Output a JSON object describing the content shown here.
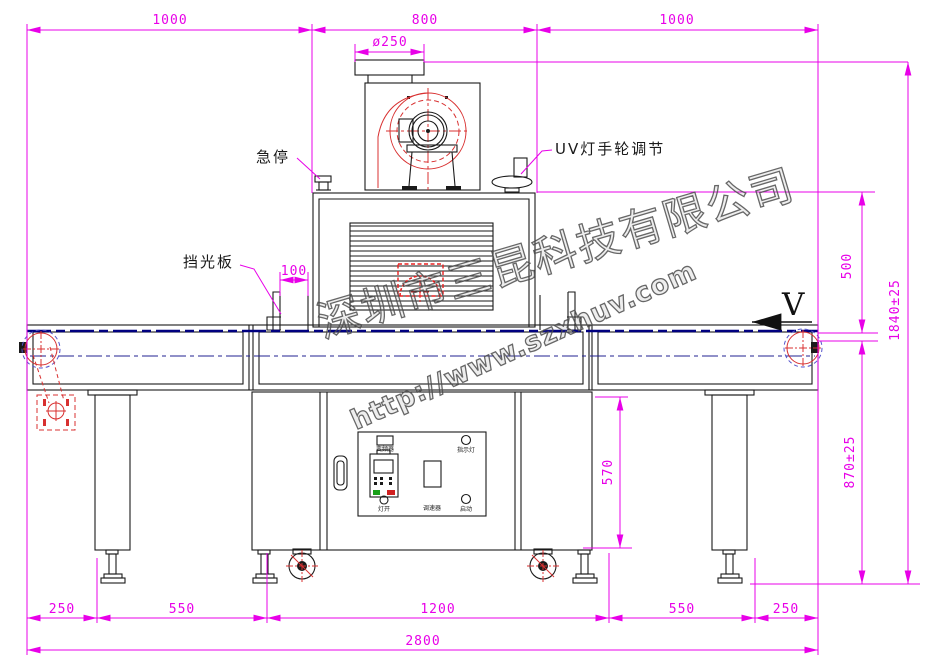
{
  "drawing": {
    "watermark": {
      "company": "深圳市三昆科技有限公司",
      "url": "http://www.szxhuv.com"
    },
    "labels": {
      "estop": "急停",
      "uv_handwheel": "UV灯手轮调节",
      "light_shield": "挡光板",
      "direction": "V"
    },
    "panel": {
      "inverter": "变频器",
      "indicator": "指示灯",
      "lamp_on": "灯开",
      "speed": "调速器",
      "start": "启动"
    },
    "dims": {
      "top": [
        "1000",
        "800",
        "1000"
      ],
      "flange_dia": "ø250",
      "shield_offset": "100",
      "housing_height": "500",
      "belt_height": "870±25",
      "total_height": "1840±25",
      "cabinet_height": "570",
      "bottom": [
        "250",
        "550",
        "1200",
        "550",
        "250"
      ],
      "total_width": "2800"
    },
    "colors": {
      "dimension": "#E800E8",
      "line": "#1a1a1a",
      "red": "#D83030",
      "belt": "#000080",
      "watermark": "#4d4d4d"
    }
  }
}
